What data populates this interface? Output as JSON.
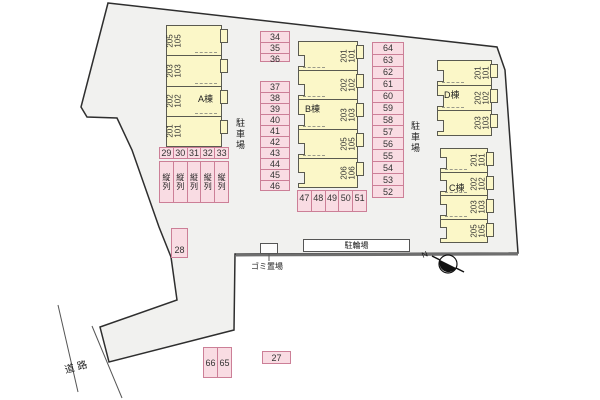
{
  "labels": {
    "road": "道路",
    "parking_left": "駐車場",
    "parking_right": "駐車場",
    "bicycle": "駐輪場",
    "garbage": "ゴミ置場",
    "north": "N"
  },
  "colors": {
    "plot_fill": "#f1f1ef",
    "plot_outline": "#2e2e2e",
    "building_fill": "#fbf7c8",
    "parking_fill": "#f9dce3",
    "parking_border": "#cc7f97"
  },
  "buildings": [
    {
      "name": "A棟",
      "units": [
        "205\n105",
        "203\n103",
        "202\n102",
        "201\n101"
      ]
    },
    {
      "name": "B棟",
      "units": [
        "201\n101",
        "202\n102",
        "203\n103",
        "205\n105",
        "206\n106"
      ]
    },
    {
      "name": "C棟",
      "units": [
        "201\n101",
        "202\n102",
        "203\n103",
        "205\n105"
      ]
    },
    {
      "name": "D棟",
      "units": [
        "201\n101",
        "202\n102",
        "203\n103"
      ]
    }
  ],
  "parking": {
    "tandem_numbers": [
      "29",
      "30",
      "31",
      "32",
      "33"
    ],
    "tandem_label": "縦列",
    "col_34_36": [
      "34",
      "35",
      "36"
    ],
    "col_37_46": [
      "37",
      "38",
      "39",
      "40",
      "41",
      "42",
      "43",
      "44",
      "45",
      "46"
    ],
    "col_64_52": [
      "64",
      "63",
      "62",
      "61",
      "60",
      "59",
      "58",
      "57",
      "56",
      "55",
      "54",
      "53",
      "52"
    ],
    "row_47_51": [
      "47",
      "48",
      "49",
      "50",
      "51"
    ],
    "space_28": "28",
    "space_27": "27",
    "row_66_65": [
      "66",
      "65"
    ]
  }
}
